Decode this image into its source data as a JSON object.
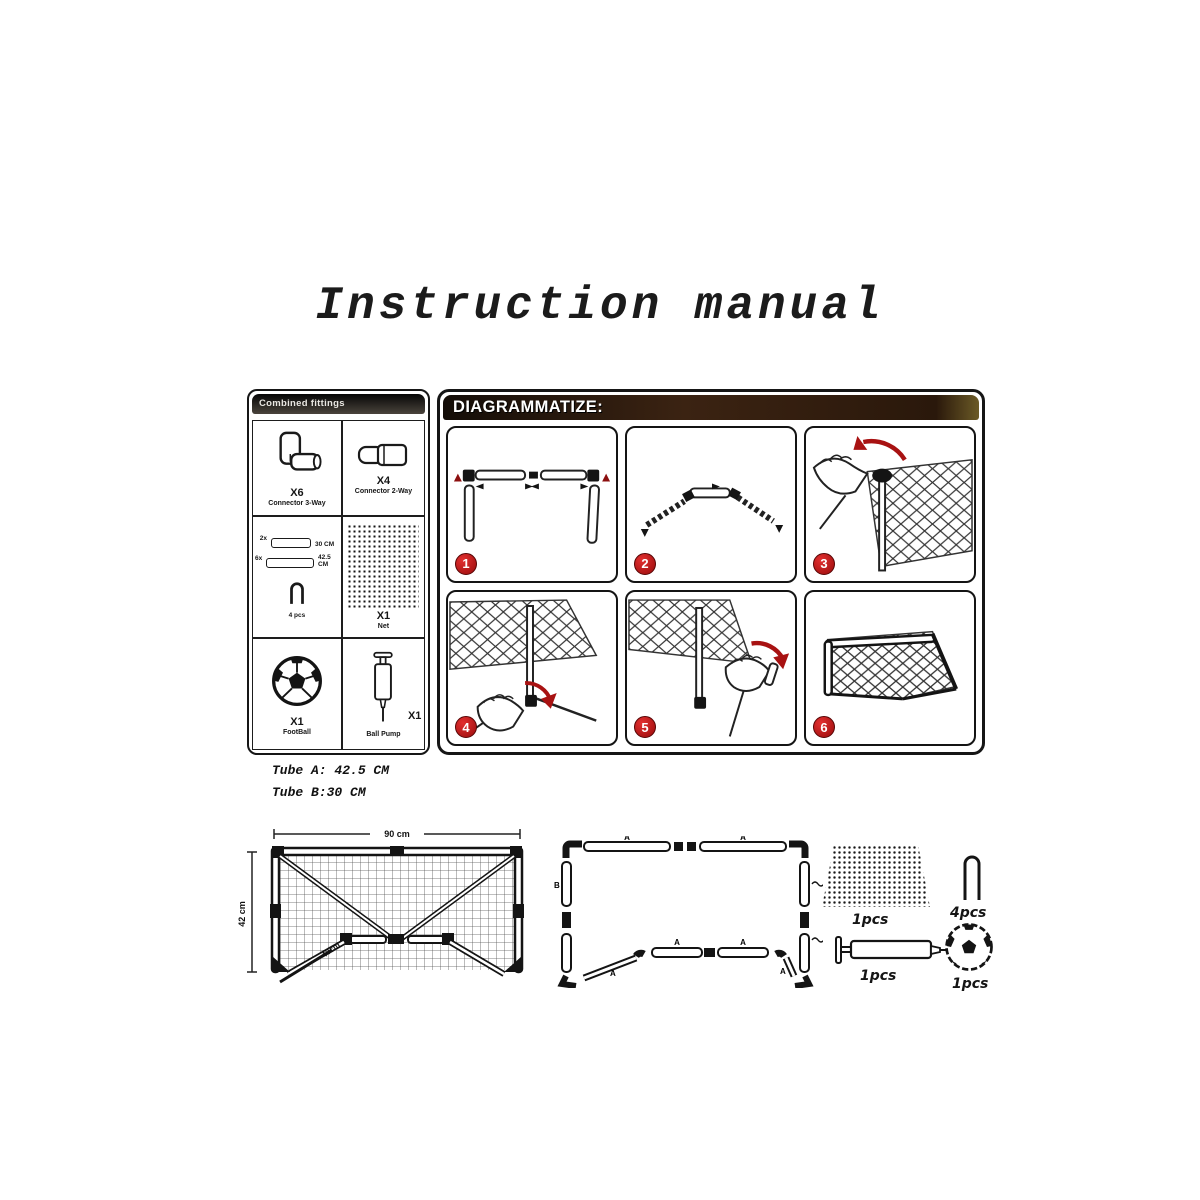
{
  "title": "Instruction manual",
  "parts_panel": {
    "header": "Combined fittings",
    "connector3": {
      "qty": "X6",
      "label": "Connector 3-Way"
    },
    "connector2": {
      "qty": "X4",
      "label": "Connector 2-Way"
    },
    "tubes": {
      "short_count": "2x",
      "short_len": "30 CM",
      "long_count": "6x",
      "long_len": "42.5 CM",
      "stake_qty": "4 pcs"
    },
    "net": {
      "qty": "X1",
      "label": "Net"
    },
    "football": {
      "qty": "X1",
      "label": "FootBall"
    },
    "pump": {
      "qty": "X1",
      "label": "Ball Pump"
    }
  },
  "diagram_panel": {
    "header": "DIAGRAMMATIZE:",
    "steps": [
      {
        "number": "1"
      },
      {
        "number": "2"
      },
      {
        "number": "3"
      },
      {
        "number": "4"
      },
      {
        "number": "5"
      },
      {
        "number": "6"
      }
    ]
  },
  "tube_notes": {
    "line1": "Tube A: 42.5 CM",
    "line2": "Tube B:30 CM"
  },
  "front_view": {
    "width_label": "90 cm",
    "height_label": "42 cm",
    "depth_label": "40cm"
  },
  "frame_layout": {
    "tube_a": "A",
    "tube_b": "B"
  },
  "bottom_items": {
    "net_qty": "1pcs",
    "stake_qty": "4pcs",
    "pump_qty": "1pcs",
    "ball_qty": "1pcs"
  },
  "colors": {
    "accent_red": "#a81212",
    "header_brown": "#3b2312",
    "parts_header_dark": "#1a1714"
  }
}
